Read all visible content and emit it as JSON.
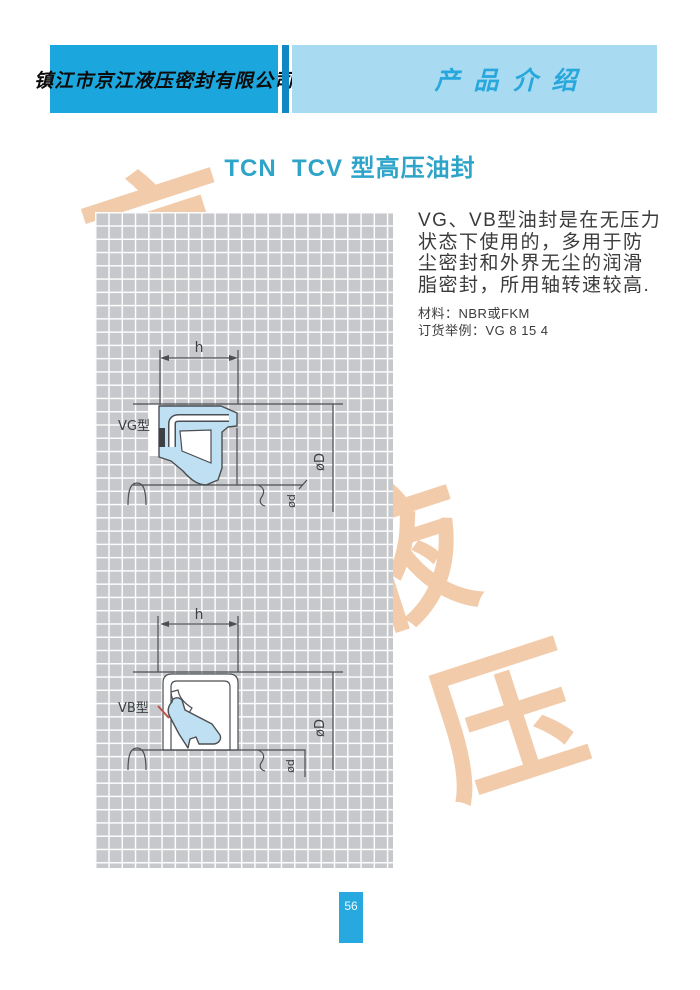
{
  "header": {
    "company_name": "镇江市京江液压密封有限公司",
    "section_title": "产品介绍"
  },
  "title": {
    "text": "TCN  TCV 型高压油封",
    "color": "#2ea4c9"
  },
  "description": {
    "lines": [
      "VG、VB型油封是在无压力",
      "状态下使用的，多用于防",
      "尘密封和外界无尘的润滑",
      "脂密封，所用轴转速较高."
    ]
  },
  "specs": {
    "material": "材料：NBR或FKM",
    "order_example": "订货举例：VG 8 15 4"
  },
  "watermark": {
    "characters": [
      "京",
      "江",
      "液",
      "压"
    ],
    "color": "rgba(227,140,66,0.45)"
  },
  "diagrams": [
    {
      "id": "vg",
      "label": "VG型",
      "dims": {
        "width_label": "h",
        "outer_diameter": "øD",
        "inner_diameter": "ød"
      }
    },
    {
      "id": "vb",
      "label": "VB型",
      "dims": {
        "width_label": "h",
        "outer_diameter": "øD",
        "inner_diameter": "ød"
      }
    }
  ],
  "page_number": "56",
  "colors": {
    "header_left_bar": "#1ba7de",
    "header_divider": "#1287c6",
    "header_right_bar": "#a8dbf1",
    "section_title_text": "#28a7dc",
    "grid_cell": "#c6c8cb",
    "grid_line": "#fdfdfd",
    "seal_fill": "#bfe0f2",
    "line_color": "#4b4e52",
    "page_number_box": "#27a9e0"
  }
}
